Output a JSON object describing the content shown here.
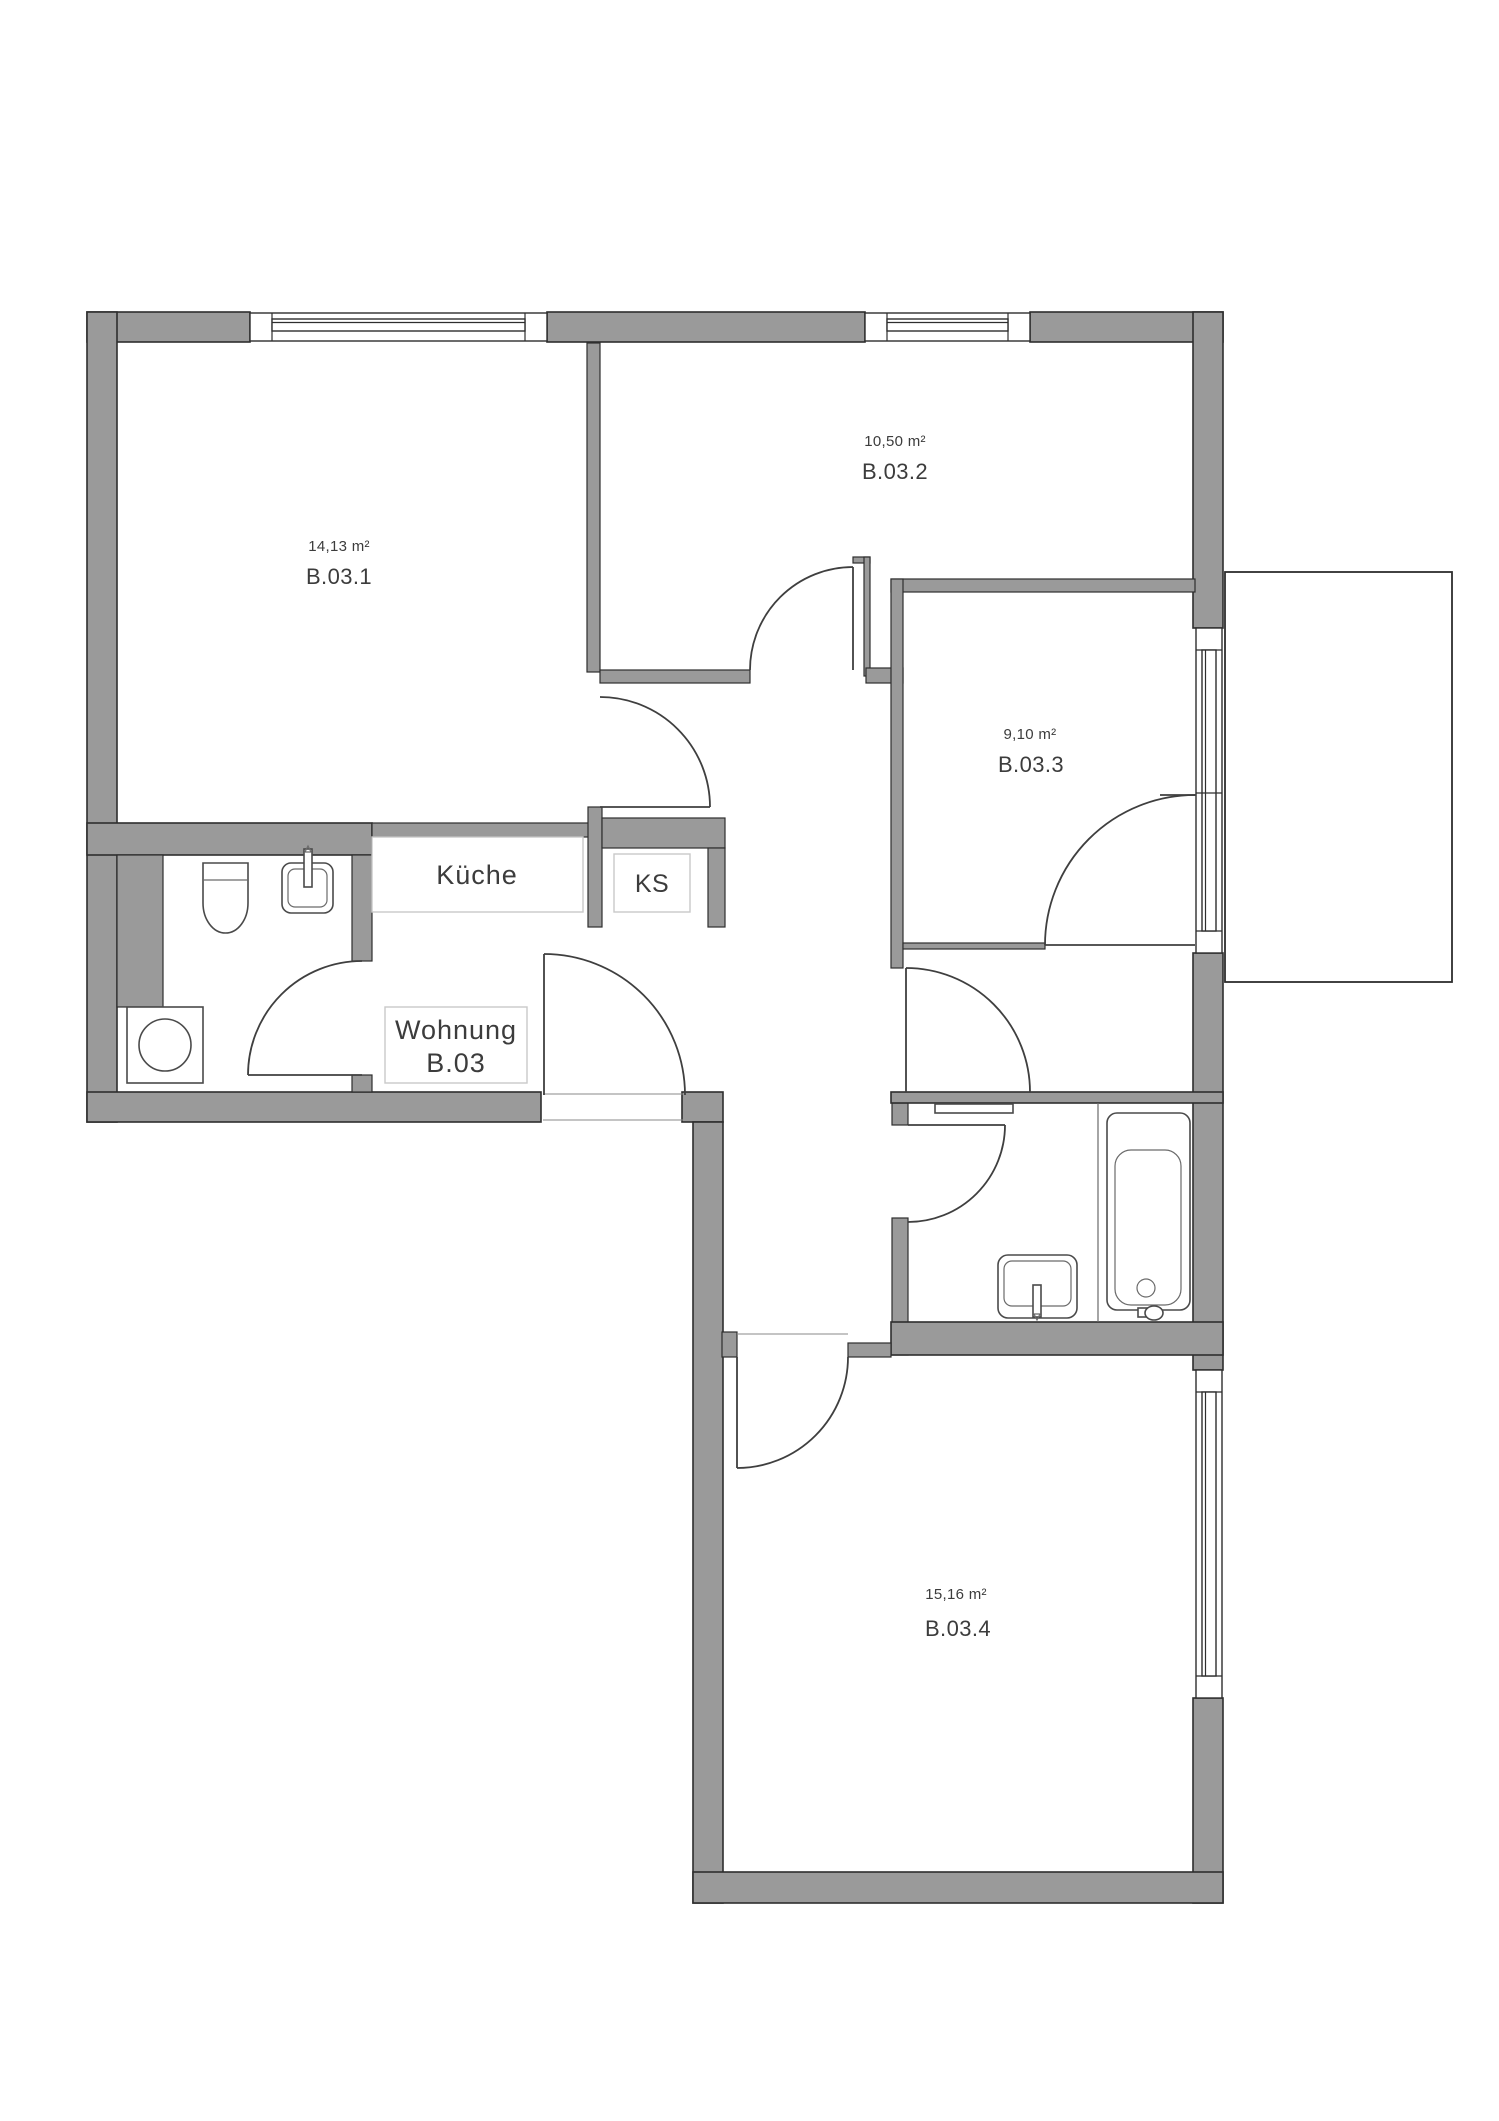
{
  "title": "Wohnung B.03",
  "rooms": [
    {
      "area": "14,13 m²",
      "name": "B.03.1"
    },
    {
      "area": "10,50 m²",
      "name": "B.03.2"
    },
    {
      "area": "9,10 m²",
      "name": "B.03.3"
    },
    {
      "area": "15,16 m²",
      "name": "B.03.4"
    }
  ],
  "labels": {
    "kitchen": "Küche",
    "fridge": "KS",
    "unit_line1": "Wohnung",
    "unit_line2": "B.03"
  },
  "colors": {
    "wall_fill": "#9a9a9a",
    "wall_stroke": "#2e2e2e",
    "door_line": "#3f3f3f",
    "fixture_line": "#4a4a4a",
    "text": "#3c3c3c",
    "label_box_border": "#c9c9c9",
    "background": "#ffffff"
  }
}
